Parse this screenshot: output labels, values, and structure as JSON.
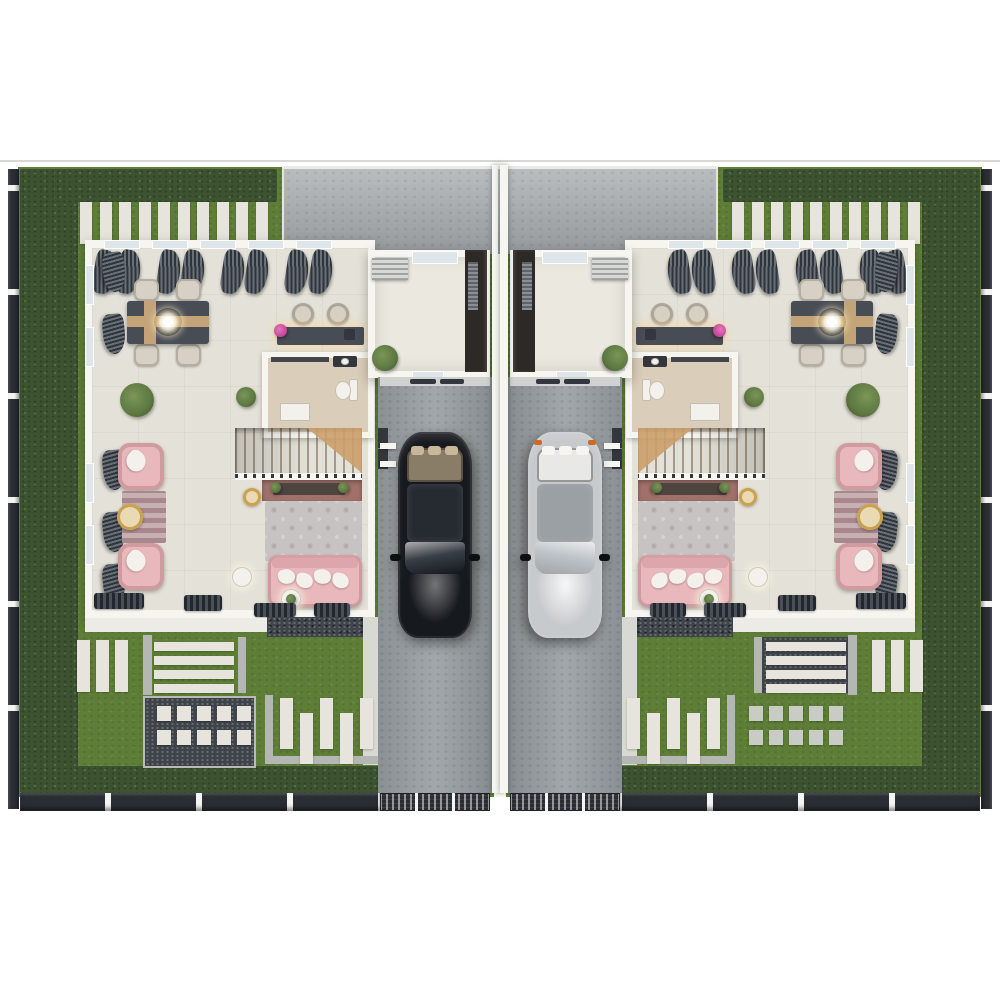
{
  "palette": {
    "page_bg": "#ffffff",
    "divider": "#d7d7d3",
    "hedge": "#3c5230",
    "hedge_dark": "#2f4426",
    "grass": "#5e7e37",
    "grass_light": "#6e9040",
    "fence": "#2a2e34",
    "fence_gap": "#f4f4f2",
    "concrete_apron": "#a6aaae",
    "concrete_drive": "#9aa0a4",
    "wall": "#f6f5f0",
    "floor": "#e4e2d8",
    "bath_floor": "#dacdb9",
    "wood": "#b2824f",
    "wood_light": "#cb9e6a",
    "table_dark": "#474c55",
    "table_wood": "#c3a377",
    "chair": "#d7d1c5",
    "pink": "#e9b8bc",
    "pink_dark": "#d9a0a7",
    "rug": "#c8c3c3",
    "runner": "#a9888d",
    "runner_light": "#c6b0b2",
    "tv_wall": "#a1706a",
    "console": "#4e4540",
    "gold": "#c9a24b",
    "gold_light": "#ead9b5",
    "white_furniture": "#f3f1eb",
    "door": "#2c2926",
    "curtain_dark": "#2f343b",
    "curtain_light": "#6a7077",
    "window_glass": "#dfe6ea",
    "paver": "#e6e4dc",
    "gravel": "#3f444b",
    "path_gray": "#b4b7b3",
    "walkway": "#edebe5",
    "plant": "#5d7841",
    "flower": "#c6439a",
    "car_black_body": "#16191e",
    "car_black_roof": "#262b31",
    "car_silver_body": "#c7cacc",
    "car_silver_roof": "#9aa0a3",
    "car_interior": "#c9b79a",
    "ac_unit": "#d7d9d7",
    "mat_dark": "#33373d"
  },
  "scene": {
    "type": "top-down 3d render, twin-house (duplex) ground floor plan, mirrored units",
    "units": [
      {
        "id": "unit-left",
        "car": {
          "location": "carport",
          "color_name": "black"
        },
        "rooms": [
          "dining-room",
          "breakfast-bar",
          "bathroom",
          "staircase",
          "living-room",
          "entry-foyer",
          "carport",
          "garden-yard"
        ],
        "furniture": {
          "dining_chairs": 4,
          "bar_stools": 2,
          "armchairs": 2,
          "sofas": 1,
          "throw_pillows": 4,
          "coffee_tables": 1,
          "side_tables": 3,
          "rugs": 2,
          "plants": 4,
          "fixtures": [
            "chandelier",
            "toilet",
            "shower-tray",
            "vanity",
            "tv-console",
            "ac-unit",
            "front-door"
          ]
        },
        "garden": {
          "stepping_stones_top": 10,
          "slab_panel": 3,
          "stripe_panel_bars": 4,
          "grid_panel_squares": 10,
          "key_panel_bars": 5,
          "stripe_panel_ground": "grass",
          "grid_panel_ground": "dark-gravel"
        }
      },
      {
        "id": "unit-right",
        "car": {
          "location": "carport",
          "color_name": "silver"
        },
        "rooms": [
          "dining-room",
          "breakfast-bar",
          "bathroom",
          "staircase",
          "living-room",
          "entry-foyer",
          "carport",
          "garden-yard"
        ],
        "furniture": {
          "dining_chairs": 4,
          "bar_stools": 2,
          "armchairs": 2,
          "sofas": 1,
          "throw_pillows": 4,
          "coffee_tables": 1,
          "side_tables": 3,
          "rugs": 2,
          "plants": 4,
          "fixtures": [
            "chandelier",
            "toilet",
            "shower-tray",
            "vanity",
            "tv-console",
            "ac-unit",
            "front-door"
          ]
        },
        "garden": {
          "stepping_stones_top": 10,
          "slab_panel": 3,
          "stripe_panel_bars": 4,
          "grid_panel_squares": 10,
          "key_panel_bars": 5,
          "stripe_panel_ground": "dark-gravel",
          "grid_panel_ground": "grass"
        }
      }
    ],
    "perimeter": [
      "dark-slat-fence",
      "hedge-border",
      "rear-gates"
    ]
  }
}
